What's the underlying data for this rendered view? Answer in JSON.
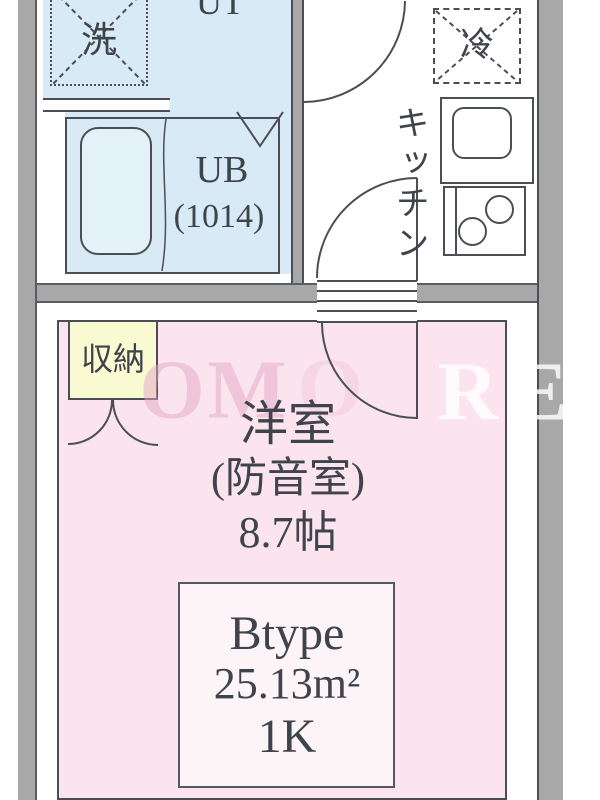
{
  "colors": {
    "wall_gray": "#a8a8a8",
    "wall_edge": "#5a5d63",
    "line_dark": "#4b4e54",
    "text_dark": "#3f444c",
    "water_blue": "#d7eaf5",
    "tub_blue": "#e3f1f8",
    "room_pink": "#fce4ee",
    "unit_box_pink": "#fdf4f8",
    "storage_yellow": "#f9f9d2",
    "watermark_pink": "rgba(226,168,195,0.5)",
    "watermark_white": "rgba(255,255,255,0.8)"
  },
  "labels": {
    "utility_partial": "UT",
    "washer": "洗",
    "unit_bath_line1": "UB",
    "unit_bath_line2": "(1014)",
    "fridge": "冷",
    "kitchen": "キッチン",
    "storage": "収納",
    "main_room_line1": "洋室",
    "main_room_line2": "(防音室)",
    "main_room_line3": "8.7帖",
    "unit_type": "Btype",
    "unit_area": "25.13m²",
    "unit_layout": "1K"
  },
  "watermark": {
    "letters": [
      "O",
      "M",
      "O",
      "R",
      "E"
    ]
  }
}
